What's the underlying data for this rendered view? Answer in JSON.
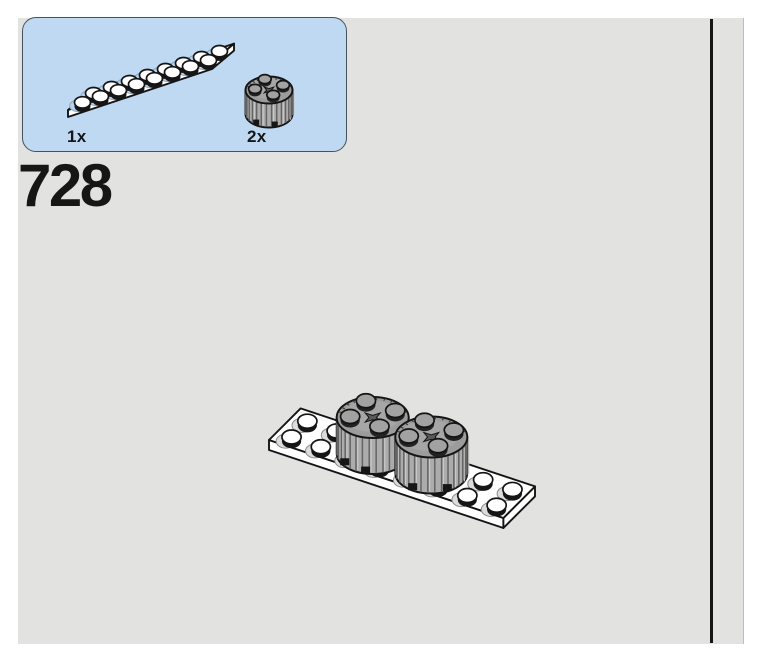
{
  "step": {
    "number": "728"
  },
  "parts_callout": {
    "parts": [
      {
        "count": "1x",
        "part": "plate-2x8-white"
      },
      {
        "count": "2x",
        "part": "round-brick-2x2-gray-ribbed"
      }
    ]
  },
  "colors": {
    "page_bg": "#e2e2e0",
    "margin_bg": "#ffffff",
    "callout_bg": "#bfd9f2",
    "callout_border": "#46525c",
    "divider": "#161616",
    "text": "#161616",
    "outline": "#141414",
    "plate_white": "#ffffff",
    "brick_gray": "#acacac",
    "brick_top_gray": "#9c9c9c",
    "stud_top_gray": "#a2a2a2",
    "rib_gray": "#646464",
    "shadow_on_plate": "#dcdcda",
    "shadow_on_plate_stroke": "#8a8a8a",
    "shadow_on_callout_plate": "#b9d2ea",
    "shadow_on_callout_plate_stroke": "#86a6c4"
  }
}
